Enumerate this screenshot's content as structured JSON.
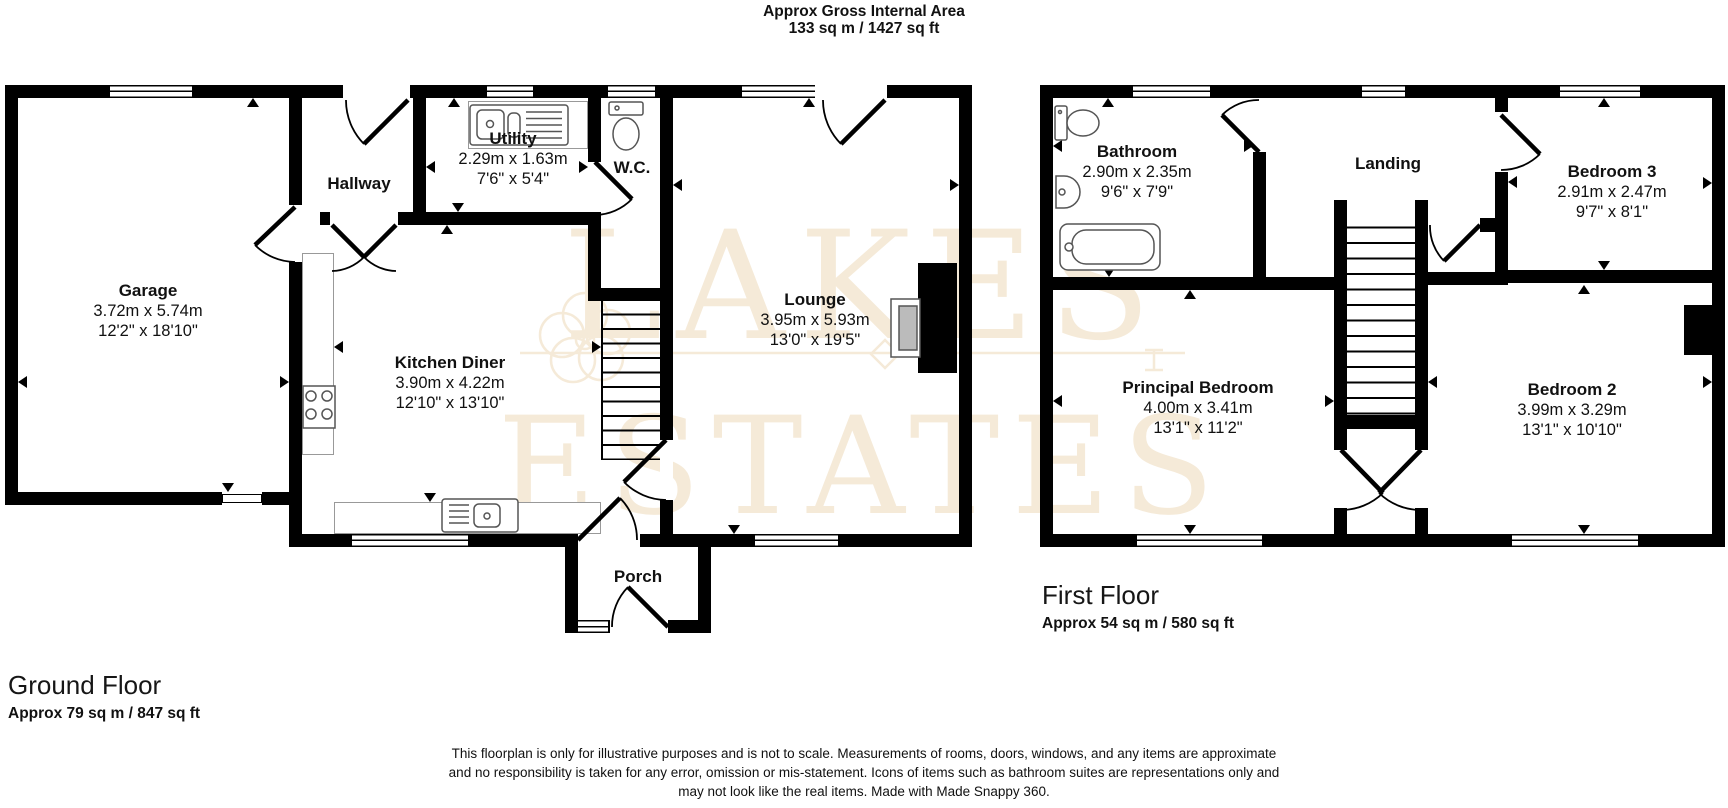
{
  "title": {
    "line1": "Approx Gross Internal Area",
    "line2": "133 sq m / 1427 sq ft"
  },
  "watermark": {
    "line1": "LAKES",
    "line2": "ESTATES"
  },
  "colors": {
    "wall": "#000000",
    "watermark": "#f5ead8",
    "fixture_outline": "#555555",
    "counter_outline": "#999999"
  },
  "ground_floor": {
    "heading": "Ground Floor",
    "area": "Approx 79 sq m / 847 sq ft",
    "rooms": [
      {
        "name": "Garage",
        "metric": "3.72m x 5.74m",
        "imperial": "12'2\" x 18'10\""
      },
      {
        "name": "Hallway"
      },
      {
        "name": "Utility",
        "metric": "2.29m x 1.63m",
        "imperial": "7'6\" x 5'4\""
      },
      {
        "name": "W.C."
      },
      {
        "name": "Kitchen Diner",
        "metric": "3.90m x 4.22m",
        "imperial": "12'10\" x 13'10\""
      },
      {
        "name": "Lounge",
        "metric": "3.95m x 5.93m",
        "imperial": "13'0\" x 19'5\""
      },
      {
        "name": "Porch"
      }
    ]
  },
  "first_floor": {
    "heading": "First Floor",
    "area": "Approx 54 sq m / 580 sq ft",
    "rooms": [
      {
        "name": "Bathroom",
        "metric": "2.90m x 2.35m",
        "imperial": "9'6\" x 7'9\""
      },
      {
        "name": "Landing"
      },
      {
        "name": "Bedroom 3",
        "metric": "2.91m x 2.47m",
        "imperial": "9'7\" x 8'1\""
      },
      {
        "name": "Principal Bedroom",
        "metric": "4.00m x 3.41m",
        "imperial": "13'1\" x 11'2\""
      },
      {
        "name": "Bedroom 2",
        "metric": "3.99m x 3.29m",
        "imperial": "13'1\" x 10'10\""
      }
    ]
  },
  "fixtures": [
    "toilet-icon",
    "basin-icon",
    "bathtub-icon",
    "sink-drainer-icon",
    "hob-icon",
    "fireplace",
    "staircase",
    "window",
    "door-swing",
    "measure-arrow"
  ],
  "disclaimer": {
    "line1": "This floorplan is only for illustrative purposes and is not to scale. Measurements of rooms, doors, windows, and any items are approximate",
    "line2": "and no responsibility is taken for any error, omission or mis-statement. Icons of items such as bathroom suites are representations only and",
    "line3": "may not look like the real items. Made with Made Snappy 360."
  }
}
